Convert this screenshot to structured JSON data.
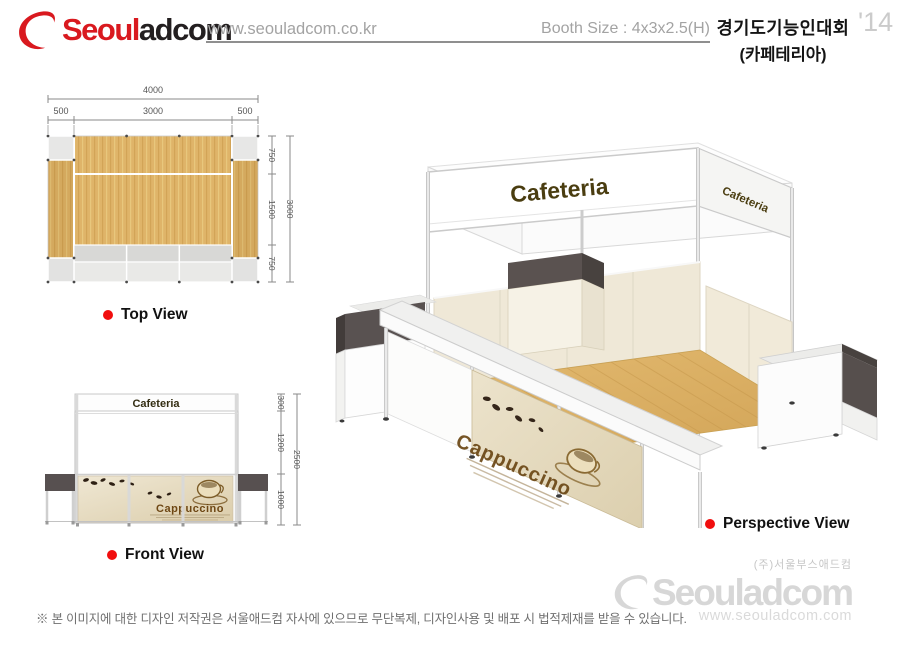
{
  "header": {
    "brand_red": "Seoul",
    "brand_black": "adcom",
    "website": "www.seouladcom.co.kr",
    "booth_size": "Booth Size : 4x3x2.5(H)",
    "event_title": "경기도기능인대회",
    "event_subtitle": "(카페테리아)",
    "year": "'14"
  },
  "top_view": {
    "label": "Top View",
    "dim_total_width": "4000",
    "dim_left": "500",
    "dim_center": "3000",
    "dim_right": "500",
    "dim_depth_top": "750",
    "dim_depth_mid": "1500",
    "dim_depth_bottom": "750",
    "dim_depth_total": "3000"
  },
  "front_view": {
    "label": "Front View",
    "fascia_text": "Cafeteria",
    "counter_graphic_text": "Cappuccino",
    "dim_fascia": "300",
    "dim_wall": "1200",
    "dim_counter": "1000",
    "dim_total_height": "2500"
  },
  "perspective_view": {
    "label": "Perspective View",
    "fascia_front_text": "Cafeteria",
    "fascia_side_text": "Cafeteria",
    "counter_graphic_text": "Cappuccino"
  },
  "footer": {
    "company_name": "(주)서울부스애드컴",
    "brand_watermark": "Seouladcom",
    "website": "www.seouladcom.com",
    "disclaimer": "※ 본 이미지에 대한 디자인 저작권은 서울애드컴 자사에 있으므로 무단복제, 디자인사용 및 배포 시 법적제재를 받을 수 있습니다."
  },
  "colors": {
    "brand_red": "#d9191f",
    "dark_panel": "#5a5250",
    "wood": "#ddb368",
    "wall_beige": "#f0e9d8",
    "muted_text": "#a3a3a3",
    "watermark": "#d7d7d7"
  }
}
